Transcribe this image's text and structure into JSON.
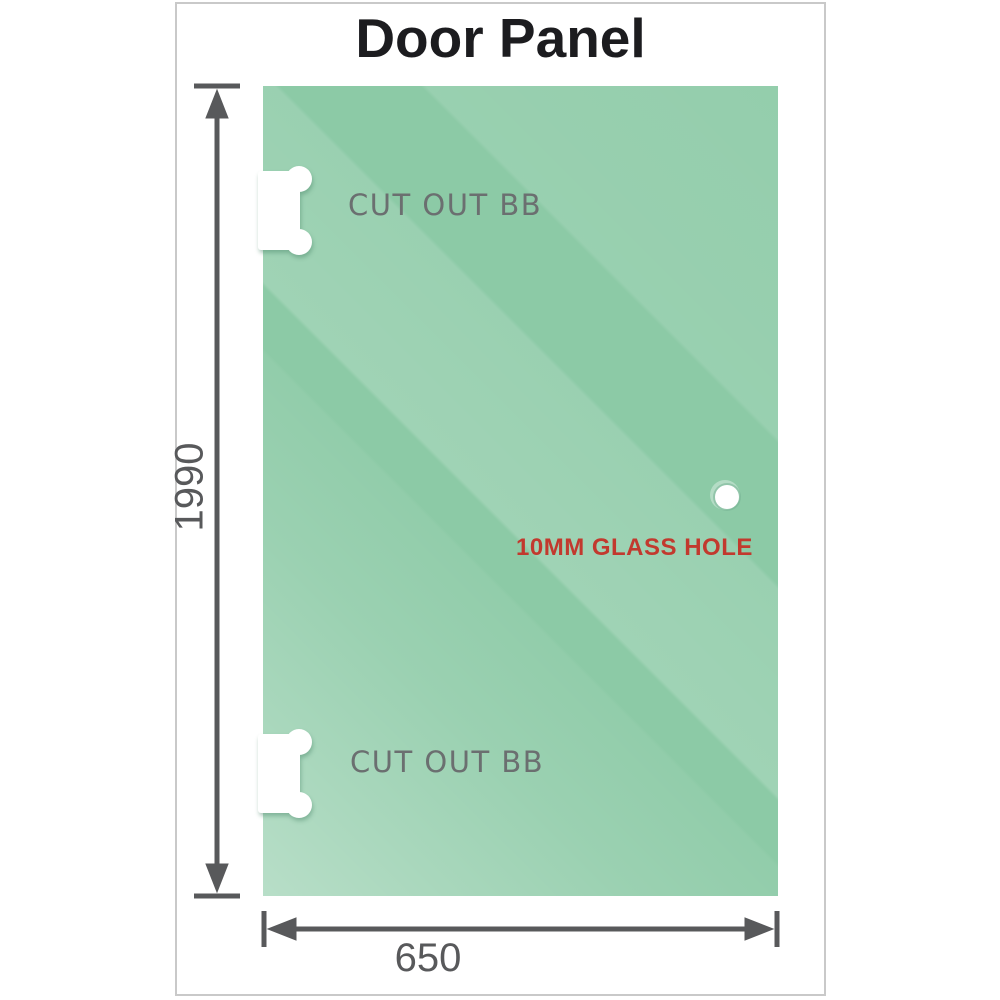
{
  "title": "Door Panel",
  "panel": {
    "cutouts": [
      {
        "label": "CUT OUT BB"
      },
      {
        "label": "CUT OUT BB"
      }
    ],
    "glass_hole_label": "10MM GLASS HOLE"
  },
  "dimensions": {
    "height": "1990",
    "width": "650"
  },
  "colors": {
    "glass_green_mid": "#8ccaa6",
    "glass_green_light": "#b8e1c9",
    "glass_stripe_light": "#a5d8ba",
    "dimension_gray": "#58595b",
    "cutout_label_gray": "#6b6f70",
    "glass_hole_red": "#c2392e",
    "title_color": "#1c1c1f",
    "frame_border": "#c9c9c9"
  }
}
